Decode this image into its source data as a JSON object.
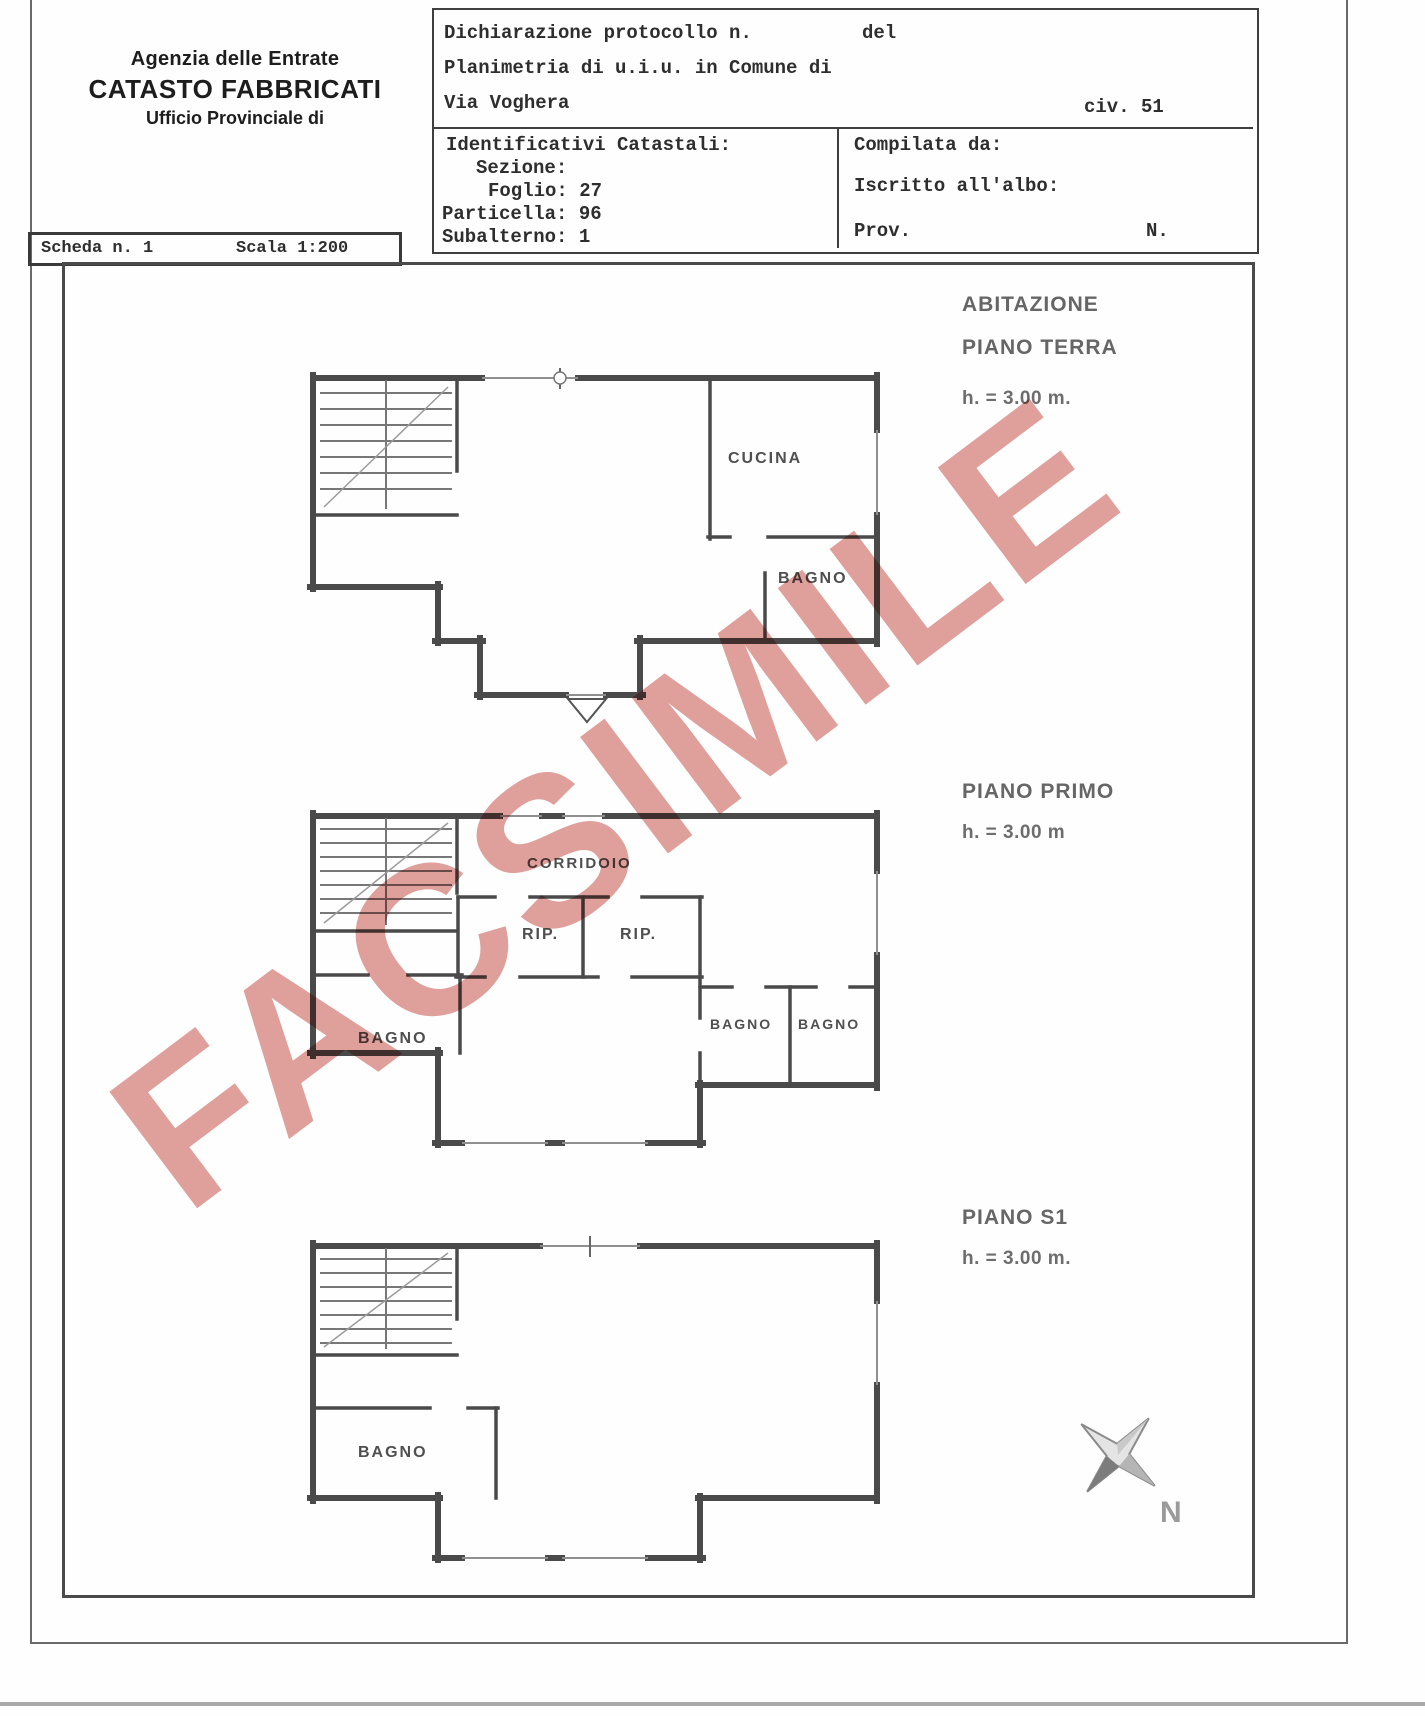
{
  "header": {
    "line1": "Agenzia delle Entrate",
    "line2": "CATASTO FABBRICATI",
    "line3": "Ufficio Provinciale di"
  },
  "protocol": {
    "dichiarazione": "Dichiarazione protocollo n.",
    "del": "del",
    "planimetria": "Planimetria di u.i.u. in Comune di",
    "via": "Via Voghera",
    "civ": "civ. 51"
  },
  "catastali": {
    "title": "Identificativi Catastali:",
    "sezione": "Sezione:",
    "foglio": "Foglio: 27",
    "particella": "Particella: 96",
    "subalterno": "Subalterno: 1"
  },
  "compilata": {
    "compilata_da": "Compilata da:",
    "iscritto": "Iscritto all'albo:",
    "prov": "Prov.",
    "n": "N."
  },
  "scheda": {
    "scheda_n": "Scheda n. 1",
    "scala": "Scala 1:200"
  },
  "watermark": "FACSIMILE",
  "floors": {
    "terra": {
      "line1": "ABITAZIONE",
      "line2": "PIANO TERRA",
      "height": "h. = 3.00 m."
    },
    "primo": {
      "line1": "PIANO PRIMO",
      "height": "h. = 3.00 m"
    },
    "s1": {
      "line1": "PIANO S1",
      "height": "h. = 3.00 m."
    }
  },
  "rooms": {
    "cucina": "CUCINA",
    "bagno_terra": "BAGNO",
    "corridoio": "CORRIDOIO",
    "rip_left": "RIP.",
    "rip_right": "RIP.",
    "bagno_primo_left": "BAGNO",
    "bagno_primo_mid": "BAGNO",
    "bagno_primo_right": "BAGNO",
    "bagno_s1": "BAGNO"
  },
  "compass": {
    "north": "N"
  },
  "colors": {
    "watermark": "#cc6159",
    "wall": "#4a4a4a",
    "ink": "#2e2e2e"
  }
}
